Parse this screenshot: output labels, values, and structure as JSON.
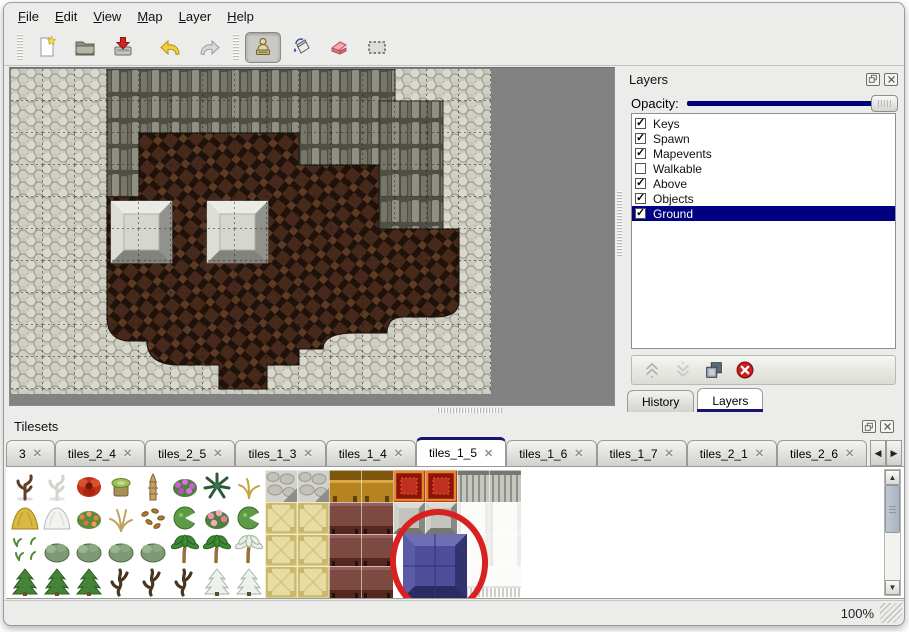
{
  "menu": {
    "items": [
      {
        "label": "File"
      },
      {
        "label": "Edit"
      },
      {
        "label": "View"
      },
      {
        "label": "Map"
      },
      {
        "label": "Layer"
      },
      {
        "label": "Help"
      }
    ]
  },
  "toolbar": {
    "groups": [
      {
        "tools": [
          {
            "icon": "new-file-icon"
          },
          {
            "icon": "open-folder-icon"
          },
          {
            "icon": "save-import-icon"
          }
        ]
      },
      {
        "tools": [
          {
            "icon": "undo-icon"
          },
          {
            "icon": "redo-icon"
          }
        ]
      },
      {
        "tools": [
          {
            "icon": "stamp-tool-icon",
            "pressed": true
          },
          {
            "icon": "fill-tool-icon"
          },
          {
            "icon": "eraser-tool-icon"
          },
          {
            "icon": "select-tool-icon"
          }
        ]
      }
    ]
  },
  "layers_panel": {
    "title": "Layers",
    "opacity_label": "Opacity:",
    "opacity_percent": 100,
    "layers": [
      {
        "name": "Keys",
        "checked": true,
        "selected": false
      },
      {
        "name": "Spawn",
        "checked": true,
        "selected": false
      },
      {
        "name": "Mapevents",
        "checked": true,
        "selected": false
      },
      {
        "name": "Walkable",
        "checked": false,
        "selected": false
      },
      {
        "name": "Above",
        "checked": true,
        "selected": false
      },
      {
        "name": "Objects",
        "checked": true,
        "selected": false
      },
      {
        "name": "Ground",
        "checked": true,
        "selected": true
      }
    ],
    "actions": [
      {
        "icon": "move-up-icon"
      },
      {
        "icon": "move-down-icon"
      },
      {
        "icon": "duplicate-layer-icon"
      },
      {
        "icon": "delete-layer-icon"
      }
    ],
    "tabs": [
      {
        "label": "History",
        "active": false
      },
      {
        "label": "Layers",
        "active": true
      }
    ]
  },
  "tilesets_panel": {
    "title": "Tilesets",
    "tabs": [
      {
        "label": "3",
        "active": false
      },
      {
        "label": "tiles_2_4",
        "active": false
      },
      {
        "label": "tiles_2_5",
        "active": false
      },
      {
        "label": "tiles_1_3",
        "active": false
      },
      {
        "label": "tiles_1_4",
        "active": false
      },
      {
        "label": "tiles_1_5",
        "active": true
      },
      {
        "label": "tiles_1_6",
        "active": false
      },
      {
        "label": "tiles_1_7",
        "active": false
      },
      {
        "label": "tiles_2_1",
        "active": false
      },
      {
        "label": "tiles_2_6",
        "active": false
      }
    ],
    "tile_grid": [
      [
        "dead-tree",
        "white-tree",
        "red-flower",
        "stump",
        "palm-trunk",
        "purple-flowers",
        "dark-palm",
        "yellow-plant",
        "stone-floor",
        "stone-floor",
        "gold-table",
        "gold-table",
        "red-carpet",
        "red-carpet",
        "gray-curtain",
        "gray-curtain"
      ],
      [
        "hay-mound",
        "snow-mound",
        "orange-flowers",
        "dry-grass",
        "leaf-litter",
        "lily-pad",
        "pink-flowers",
        "lily-pad",
        "tatami",
        "tatami",
        "brown-table",
        "brown-table",
        "gray-blocks",
        "gray-blocks",
        "white-block",
        "white-block"
      ],
      [
        "sprouts",
        "bush",
        "bush",
        "bush",
        "bush",
        "palm-tree",
        "palm-tree",
        "snow-palm",
        "tatami",
        "tatami",
        "brown-table",
        "brown-table",
        "blue-block",
        "blue-block",
        "white-block",
        "white-block"
      ],
      [
        "conifer",
        "conifer",
        "conifer",
        "twisted-tree",
        "twisted-tree",
        "twisted-tree",
        "snow-fir",
        "snow-fir",
        "tatami",
        "tatami",
        "brown-table",
        "brown-table",
        "blue-block",
        "blue-block",
        "white-fringe",
        "white-fringe"
      ]
    ],
    "annotation": {
      "type": "red-circle",
      "color": "#d82222"
    }
  },
  "statusbar": {
    "zoom": "100%"
  },
  "colors": {
    "selection": "#000080",
    "slider_track": "#00008c",
    "tab_accent": "#16166e",
    "map_background": "#828282",
    "annotation": "#d82222"
  }
}
